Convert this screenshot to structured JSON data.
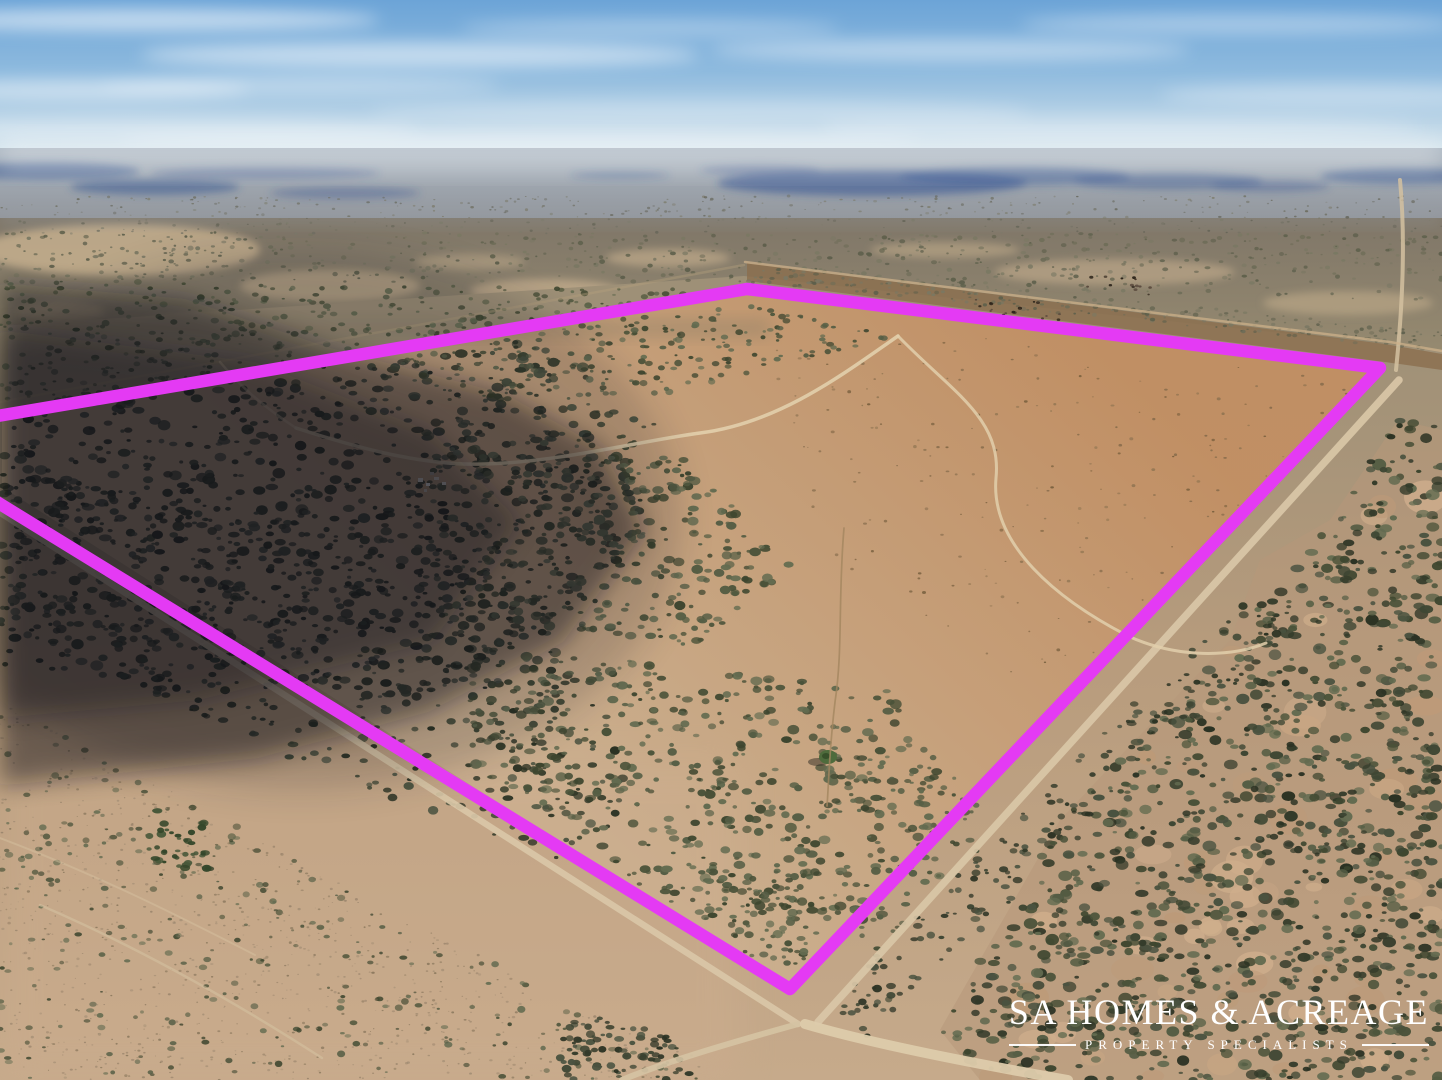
{
  "scene": {
    "description": "Aerial drone photograph of flat semi-arid acreage and mallee scrub under a hazy blue sky, with a large cloud shadow at left, dirt roads meeting at a crossroads at bottom centre, and a fuchsia property-boundary outline drawn over the land.",
    "boundary": {
      "color": "#e43af4",
      "stroke_width": 12.5,
      "points": "-26,420 747,289 1380,368 790,989 -26,488"
    },
    "sky_top_color": "#6ca4d7",
    "horizon_color": "#dde9ee"
  },
  "watermark": {
    "title": "SA HOMES & ACREAGE",
    "subtitle": "PROPERTY SPECIALISTS",
    "color": "#ffffff"
  }
}
